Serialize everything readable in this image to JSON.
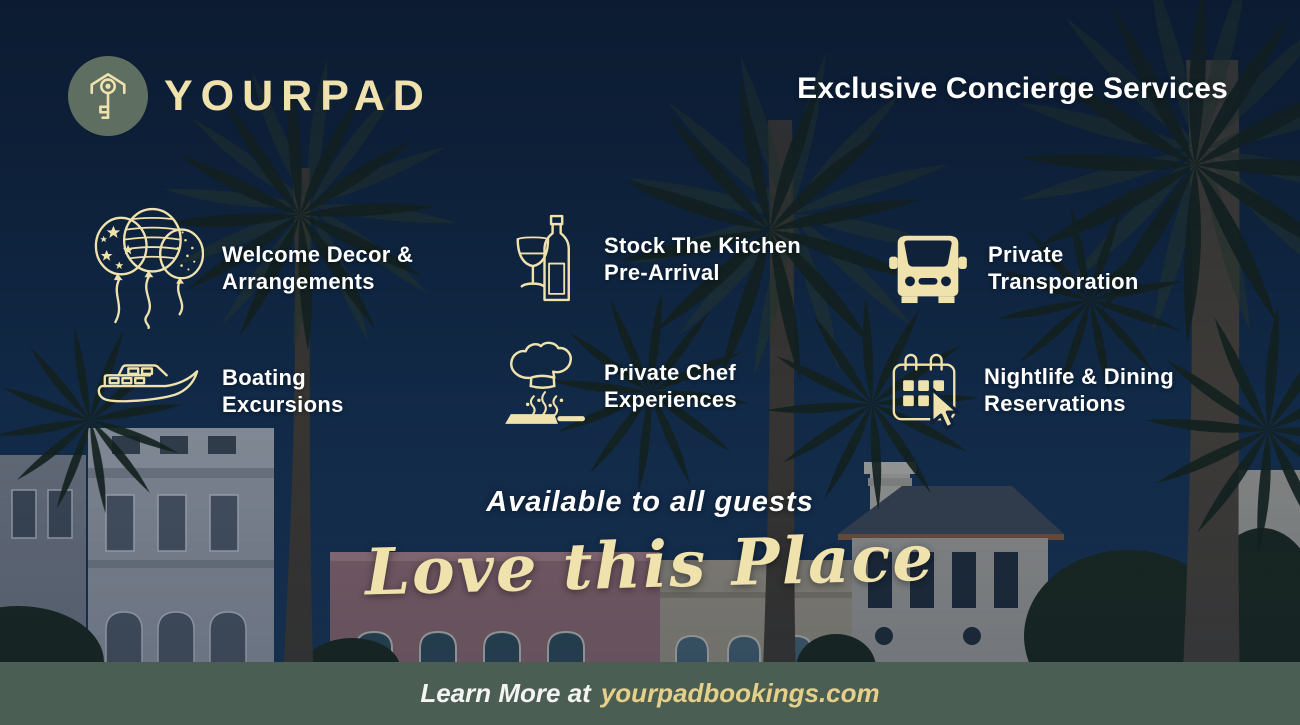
{
  "brand": {
    "name": "YOURPAD",
    "logo_icon": "key-icon"
  },
  "header": {
    "title": "Exclusive Concierge Services"
  },
  "services": {
    "items": [
      {
        "icon": "balloons-icon",
        "line1": "Welcome Decor &",
        "line2": "Arrangements"
      },
      {
        "icon": "wine-bottle-glass-icon",
        "line1": "Stock The Kitchen",
        "line2": "Pre-Arrival"
      },
      {
        "icon": "car-icon",
        "line1": "Private",
        "line2": "Transporation"
      },
      {
        "icon": "boat-icon",
        "line1": "Boating",
        "line2": "Excursions"
      },
      {
        "icon": "chef-hat-pan-icon",
        "line1": "Private Chef",
        "line2": "Experiences"
      },
      {
        "icon": "calendar-cursor-icon",
        "line1": "Nightlife & Dining",
        "line2": "Reservations"
      }
    ]
  },
  "tagline": {
    "text": "Available to all guests"
  },
  "script_line": {
    "text": "Love this Place"
  },
  "footer": {
    "prefix": "Learn More at",
    "url": "yourpadbookings.com"
  },
  "colors": {
    "cream": "#f0e2ad",
    "navy_background": "#10223a",
    "footer_green": "#4b5e53",
    "logo_circle_green": "#5e6e61",
    "footer_url_gold": "#e6d089",
    "white": "#ffffff"
  }
}
